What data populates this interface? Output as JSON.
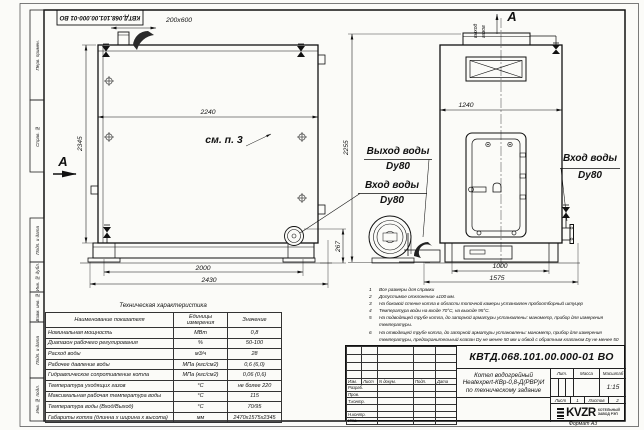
{
  "frame_labels": [
    "Перв. примен.",
    "Справ. №",
    "Подп. и дата",
    "Инв. № дубл.",
    "Взам. инв. №",
    "Подп. и дата",
    "Инв. № подл."
  ],
  "drawing": {
    "section_label": "А",
    "view_label": "А",
    "callout": "см. п. 3",
    "gas_outlet_line1": "выход",
    "gas_outlet_line2": "газов",
    "water_out_title": "Выход воды",
    "water_out_dn": "Dу80",
    "water_in_title": "Вход воды",
    "water_in_dn": "Dу80",
    "water_in_right_title": "Вход воды",
    "water_in_right_dn": "Dу80",
    "dims": {
      "chimney": "200х600",
      "side_width": "2240",
      "side_height": "2345",
      "side_span": "2000",
      "side_overall": "2430",
      "nozzle_height": "267",
      "front_width": "1240",
      "front_height": "2255",
      "front_span": "1000",
      "front_overall": "1575"
    }
  },
  "notes": [
    {
      "num": "1",
      "text": "Все размеры для справки"
    },
    {
      "num": "2",
      "text": "Допустимое отклонение ±100 мм."
    },
    {
      "num": "3",
      "text": "На боковой стенке котла в области топочной камеры установлен пробоотборный штуцер"
    },
    {
      "num": "4",
      "text": "Температура воды на входе 70°С, на выходе 95°С."
    },
    {
      "num": "5",
      "text": "На подводящей трубе котла, до запорной арматуры установлены: манометр, прибор для измерения температуры."
    },
    {
      "num": "6",
      "text": "На отводящей трубе котла, до запорной арматуры установлены: манометр, прибор для измерения температуры, предохранительный клапан Dу не менее 50 мм и обвод с обратным клапаном Dу не менее 50 мм."
    },
    {
      "num": "7",
      "text": "Остальные технические требования по ОСТ 108.030.113-84"
    }
  ],
  "spec_table": {
    "title": "Техническая характеристика",
    "headers": {
      "name": "Наименование показателя",
      "units": "Единицы измерения",
      "value": "Значение"
    },
    "rows": [
      {
        "name": "Номинальная мощность",
        "units": "МВт",
        "value": "0,8"
      },
      {
        "name": "Диапазон рабочего регулирования",
        "units": "%",
        "value": "50-100"
      },
      {
        "name": "Расход воды",
        "units": "м3/ч",
        "value": "28"
      },
      {
        "name": "Рабочее давление воды",
        "units": "МПа (кгс/см2)",
        "value": "0,6 (6,0)"
      },
      {
        "name": "Гидравлическое сопротивление котла",
        "units": "МПа (кгс/см2)",
        "value": "0,06 (0,6)"
      },
      {
        "name": "Температура уходящих газов",
        "units": "°С",
        "value": "не более 220"
      },
      {
        "name": "Максимальная рабочая температура воды",
        "units": "°С",
        "value": "115"
      },
      {
        "name": "Температура воды (Вход/Выход)",
        "units": "°С",
        "value": "70/95"
      },
      {
        "name": "Габариты котла (длинна х ширина х высота)",
        "units": "мм",
        "value": "2470х1575х2345"
      }
    ]
  },
  "title_block": {
    "doc_number": "КВТД.068.101.00.000-01 ВО",
    "product_line1": "Котел водогрейный",
    "product_line2": "Heatexpert-КВр-0,8-Д(РВР)И",
    "product_line3": "по техническому задание",
    "rev_header": [
      "Изм.",
      "Лист",
      "N докум.",
      "Подп.",
      "Дата"
    ],
    "roles": [
      "Разраб.",
      "Пров.",
      "Т.контр.",
      "",
      "Н.контр.",
      "Утв."
    ],
    "lit_label": "Лит.",
    "mass_label": "Масса",
    "scale_label": "Масштаб",
    "scale_value": "1:15",
    "sheet_label": "Лист",
    "sheet_value": "1",
    "sheets_label": "Листов",
    "sheets_value": "2",
    "logo_text": "KVZR",
    "company_line1": "КОТЕЛЬНЫЙ",
    "company_line2": "ЗАВОД РЭП",
    "format_note": "Формат А3"
  }
}
